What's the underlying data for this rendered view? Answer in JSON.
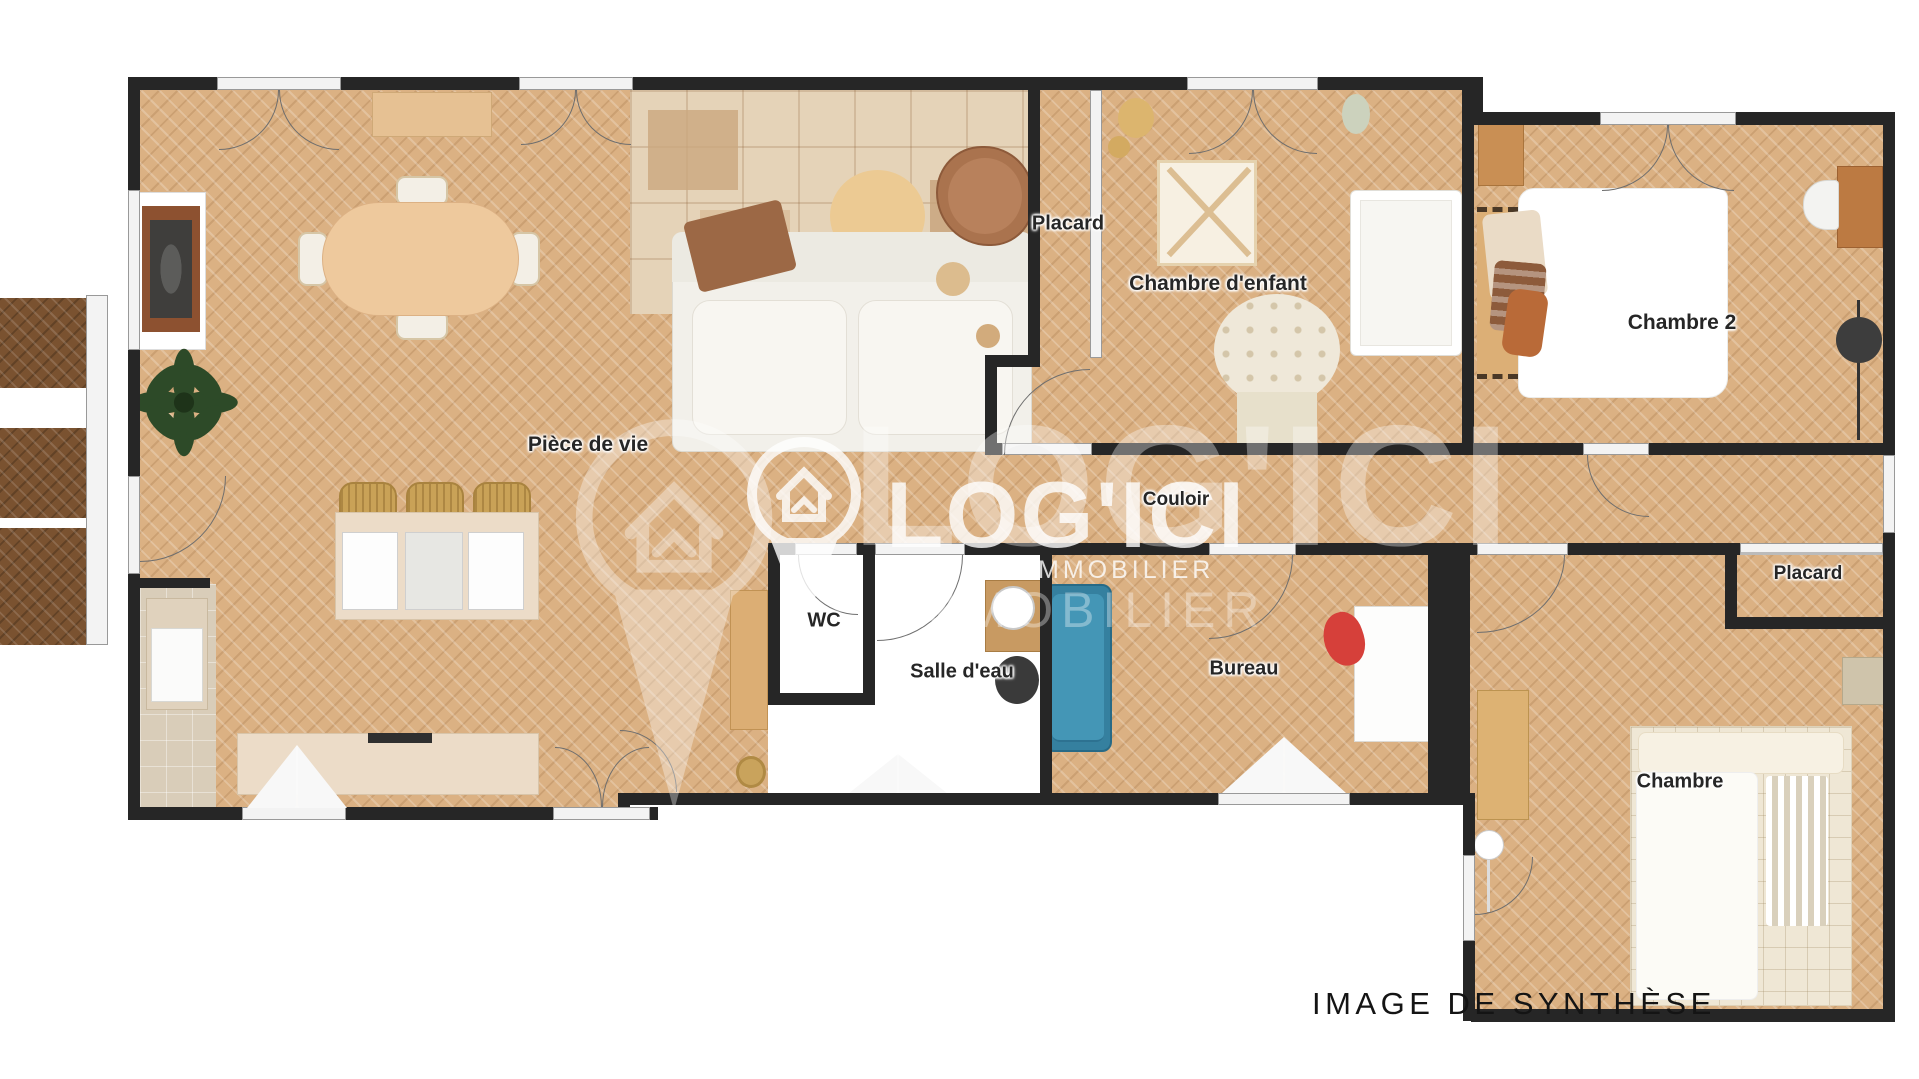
{
  "page": {
    "caption": "IMAGE DE SYNTHÈSE",
    "background": "#ffffff"
  },
  "branding": {
    "name": "LOG'ICI",
    "tagline_small": "DU IMMOBILIER",
    "tagline_large": "IMMOBILIER",
    "pin_icon": "location-pin-house-icon"
  },
  "rooms": {
    "living": {
      "label": "Pièce de vie"
    },
    "closet_top": {
      "label": "Placard"
    },
    "child_bedroom": {
      "label": "Chambre d'enfant"
    },
    "bedroom2": {
      "label": "Chambre 2"
    },
    "hallway": {
      "label": "Couloir"
    },
    "wc": {
      "label": "WC"
    },
    "shower_room": {
      "label": "Salle d'eau"
    },
    "office": {
      "label": "Bureau"
    },
    "closet_right": {
      "label": "Placard"
    },
    "bedroom": {
      "label": "Chambre"
    }
  },
  "colors": {
    "wall": "#262626",
    "parquet": "#dbb183",
    "balcony_wood": "#7a5230",
    "kitchen_tile": "#d9cdb9",
    "counter_cream": "#ecdcc8",
    "teal_sofa": "#35809f",
    "leather_armchair": "#aa734e",
    "wood_furniture": "#bc7a42",
    "red_chair": "#d6403a",
    "watermark_white": "#ffffff",
    "label_text": "#262626"
  }
}
